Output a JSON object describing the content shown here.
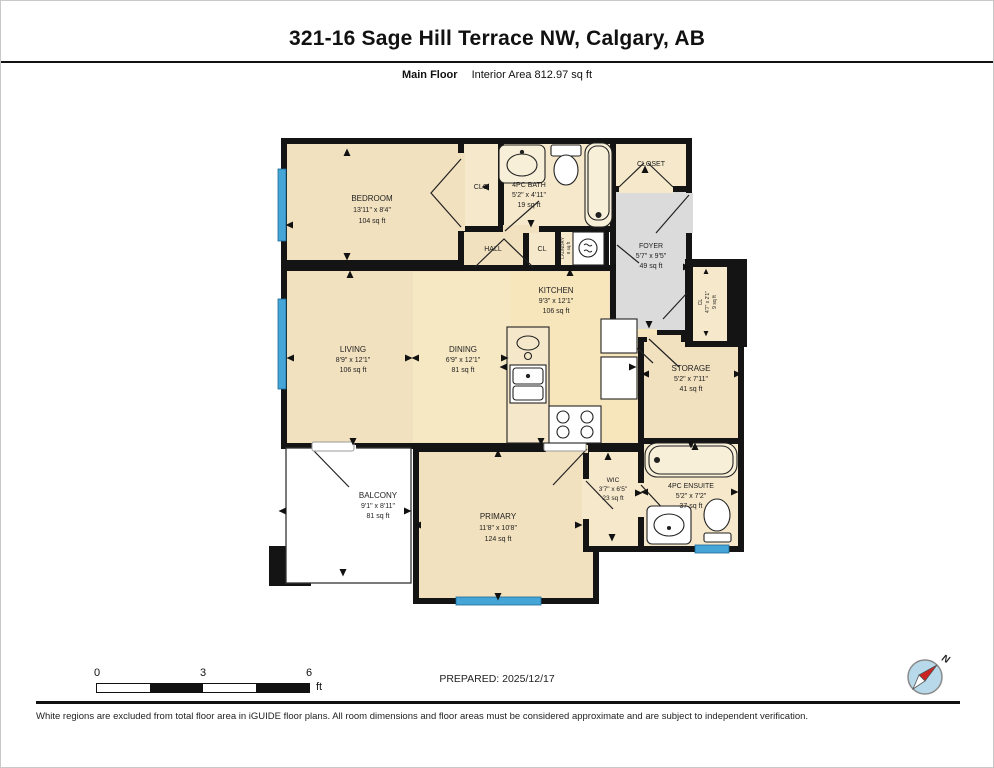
{
  "header": {
    "title": "321-16 Sage Hill Terrace NW, Calgary, AB",
    "floor_label": "Main Floor",
    "area_label": "Interior Area 812.97 sq ft"
  },
  "rooms": {
    "bedroom": {
      "name": "BEDROOM",
      "dims": "13'11\" x 8'4\"",
      "area": "104 sq ft"
    },
    "clo": {
      "name": "CLO"
    },
    "bath": {
      "name": "4PC BATH",
      "dims": "5'2\" x 4'11\"",
      "area": "19 sq ft"
    },
    "closet": {
      "name": "CLOSET"
    },
    "foyer": {
      "name": "FOYER",
      "dims": "5'7\" x 9'5\"",
      "area": "49 sq ft"
    },
    "hall": {
      "name": "HALL"
    },
    "cl": {
      "name": "CL"
    },
    "laundry": {
      "name": "LAUNDRY",
      "area": "8 sq ft"
    },
    "kitchen": {
      "name": "KITCHEN",
      "dims": "9'3\" x 12'1\"",
      "area": "106 sq ft"
    },
    "cl2": {
      "name": "CL",
      "dims": "4'7\" x 2'1\"",
      "area": "9 sq ft"
    },
    "storage": {
      "name": "STORAGE",
      "dims": "5'2\" x 7'11\"",
      "area": "41 sq ft"
    },
    "living": {
      "name": "LIVING",
      "dims": "8'9\" x 12'1\"",
      "area": "106 sq ft"
    },
    "dining": {
      "name": "DINING",
      "dims": "6'9\" x 12'1\"",
      "area": "81 sq ft"
    },
    "balcony": {
      "name": "BALCONY",
      "dims": "9'1\" x 8'11\"",
      "area": "81 sq ft"
    },
    "primary": {
      "name": "PRIMARY",
      "dims": "11'8\" x 10'8\"",
      "area": "124 sq ft"
    },
    "wic": {
      "name": "WIC",
      "dims": "3'7\" x 6'5\"",
      "area": "23 sq ft"
    },
    "ensuite": {
      "name": "4PC ENSUITE",
      "dims": "5'2\" x 7'2\"",
      "area": "37 sq ft"
    }
  },
  "footer": {
    "scale": {
      "n0": "0",
      "n3": "3",
      "n6": "6",
      "unit": "ft"
    },
    "prepared": "PREPARED: 2025/12/17",
    "compass_n": "N",
    "disclaimer": "White regions are excluded from total floor area in iGUIDE floor plans. All room dimensions and floor areas must be considered approximate and are subject to independent verification."
  },
  "colors": {
    "wall": "#141414",
    "room_beige": "#F2E1BF",
    "room_light": "#F6E8CA",
    "foyer_gray": "#DBDBDB",
    "window_blue": "#45A5D6"
  }
}
